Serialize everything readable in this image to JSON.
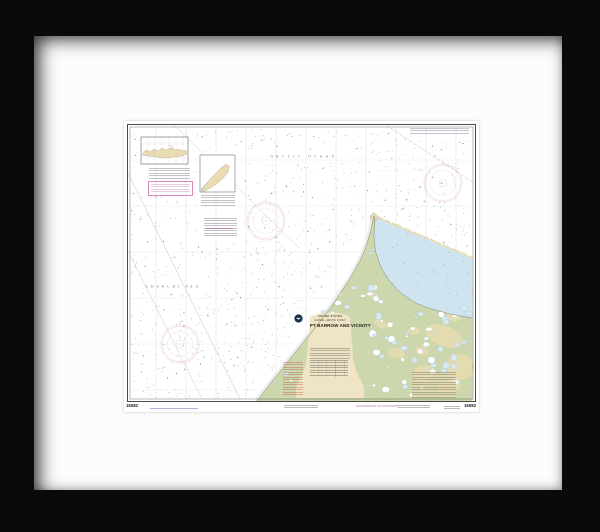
{
  "artwork": {
    "kind": "Framed nautical chart photo",
    "chart": {
      "number": "16082",
      "number_right": "16082",
      "sea_labels": {
        "arctic_ocean": "ARCTIC OCEAN",
        "chukchi_sea": "CHUKCHI SEA"
      },
      "title_block": {
        "country": "UNITED STATES",
        "region": "ALASKA - ARCTIC COAST",
        "title": "PT BARROW AND VICINITY"
      },
      "margin": {
        "soundings_note": "SOUNDINGS IN FATHOMS"
      },
      "colors": {
        "frame_black": "#0a0a0a",
        "matte_white": "#fcfcfb",
        "land_green": "#ccd7ad",
        "sand_tan": "#e9dcb2",
        "title_cream": "#efe5c6",
        "lagoon_blue": "#cfe4ee",
        "shallow_blue": "#ddecf4",
        "lake_blue": "#d6e8f0",
        "magenta": "#cf84ba",
        "grid_gray": "#9aa0aa",
        "ink": "#2b2b2b",
        "dot_ink": "#4a4a4a",
        "veg_green": "#9ab08a",
        "coast_ink": "#55604d"
      }
    }
  }
}
